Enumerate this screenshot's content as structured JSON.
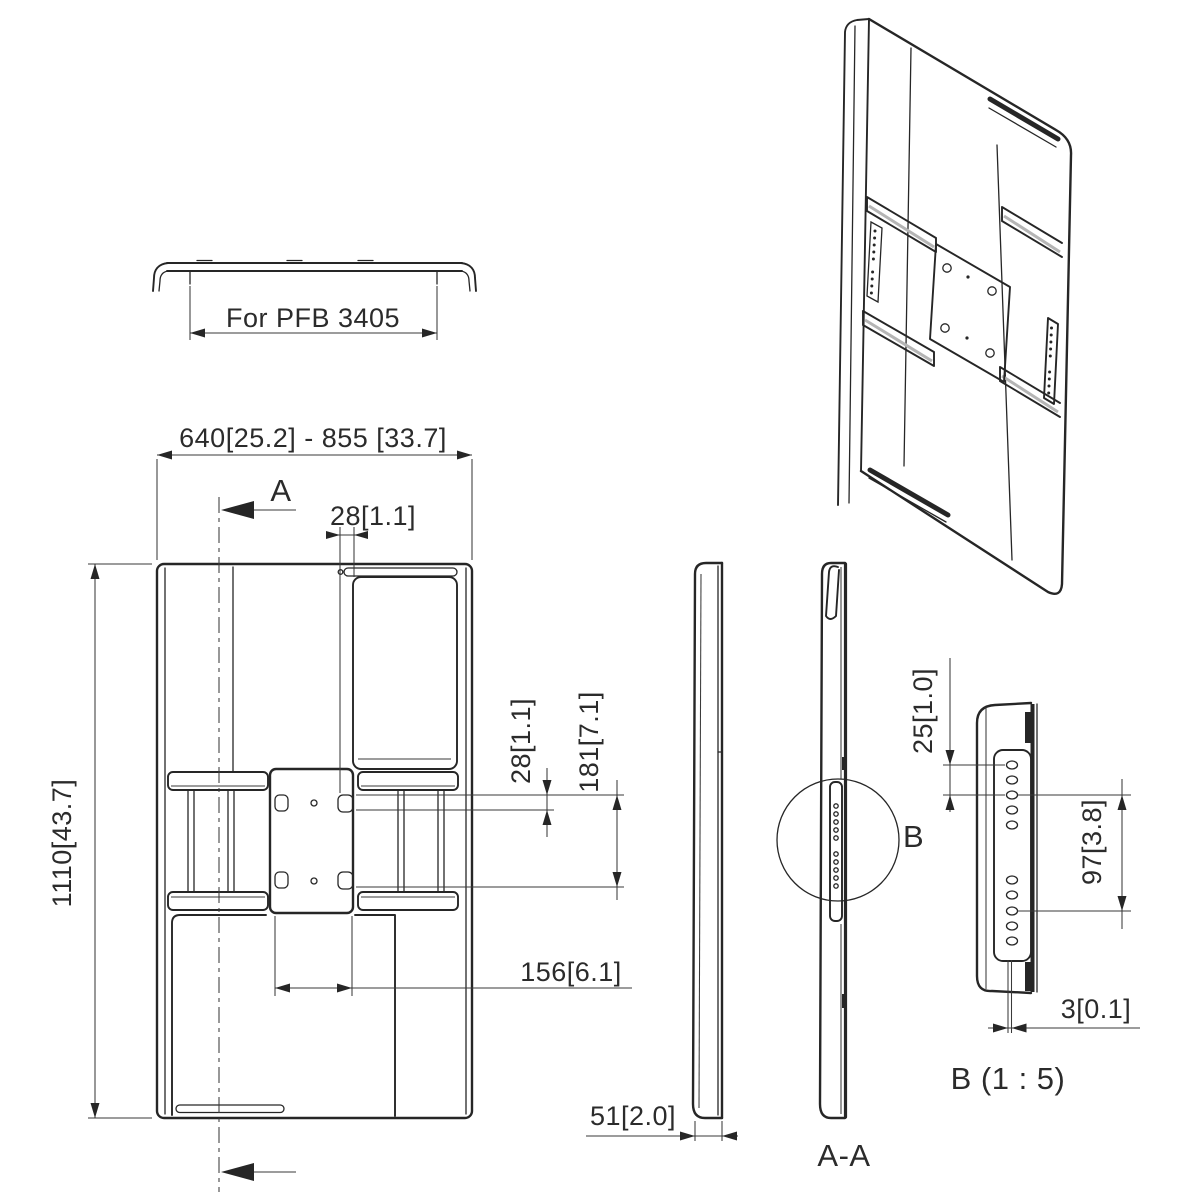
{
  "drawing_title": "Adapter bracket engineering drawing",
  "colors": {
    "line": "#262626",
    "dim_text": "#2b2b2b",
    "background": "#ffffff",
    "rail_stripe": "#b5b5b5"
  },
  "top_view": {
    "dim_label": "For PFB 3405"
  },
  "front_view": {
    "dim_width_range": "640[25.2] - 855 [33.7]",
    "dim_height": "1110[43.7]",
    "dim_slot_width": "28[1.1]",
    "dim_hole_height": "28[1.1]",
    "dim_hole_pitch_vertical": "181[7.1]",
    "dim_hole_pitch_horizontal": "156[6.1]",
    "section_label": "A"
  },
  "side_view": {
    "dim_depth": "51[2.0]"
  },
  "section_view": {
    "label": "A-A",
    "detail_marker": "B"
  },
  "detail_view": {
    "label": "B (1 : 5)",
    "dim_hole_spacing": "25[1.0]",
    "dim_group_spacing": "97[3.8]",
    "dim_plate_thickness": "3[0.1]"
  }
}
